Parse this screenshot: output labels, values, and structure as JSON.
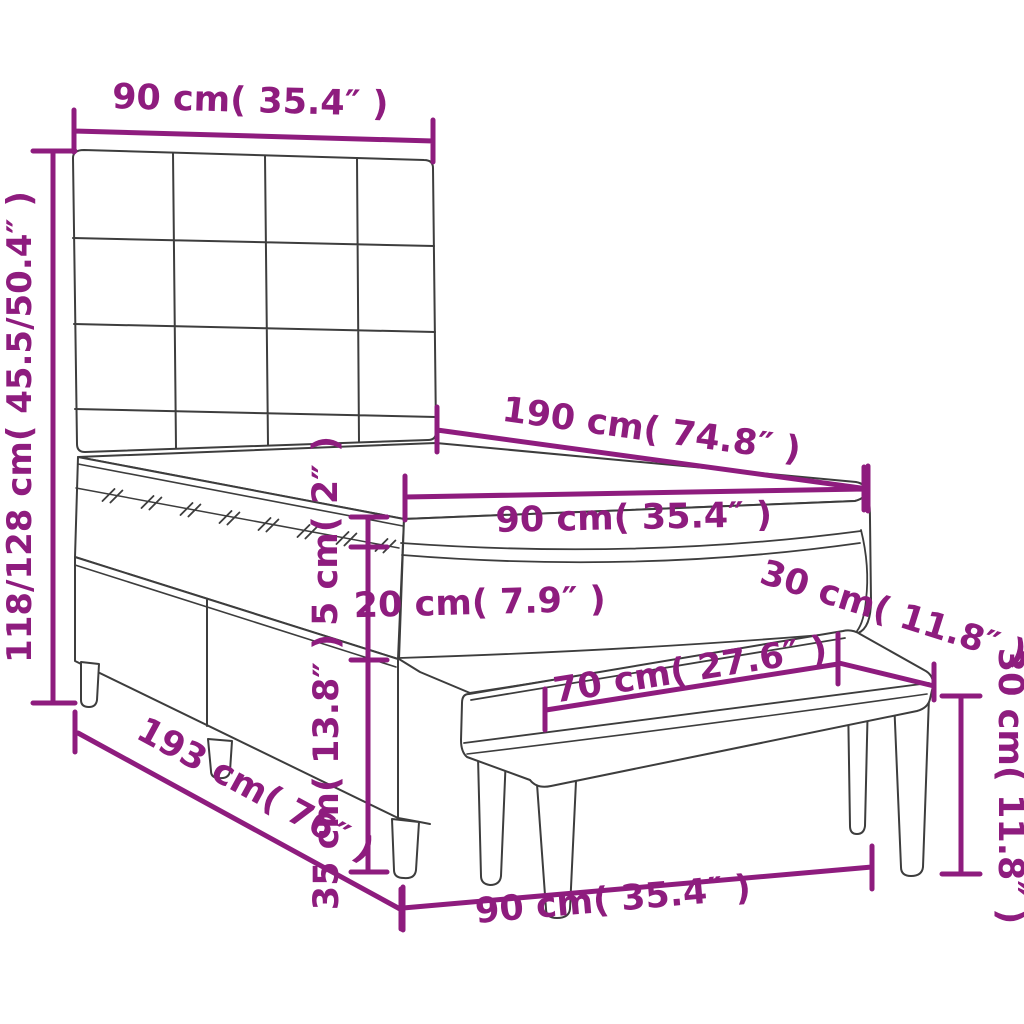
{
  "diagram": {
    "colors": {
      "dimension_accent": "#8e1c7e",
      "outline": "#3d3d3d",
      "background": "#ffffff"
    },
    "labels": {
      "headboard_width": "90 cm( 35.4″ )",
      "overall_height": "118/128 cm( 45.5/50.4″ )",
      "mattress_length": "190 cm( 74.8″ )",
      "mattress_width": "90 cm( 35.4″ )",
      "topper_thickness": "5 cm( 2″ )",
      "mattress_thickness": "20 cm( 7.9″ )",
      "base_height": "35 cm( 13.8″ )",
      "overall_length": "193 cm( 76″ )",
      "bench_length": "70 cm( 27.6″ )",
      "bench_depth": "30 cm( 11.8″ )",
      "bench_height": "30 cm( 11.8″ )",
      "bench_width": "90 cm( 35.4″ )"
    }
  }
}
